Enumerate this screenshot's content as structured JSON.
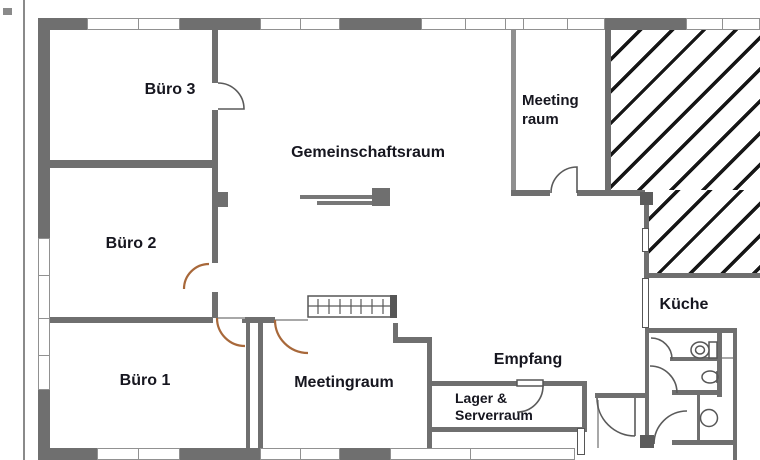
{
  "title": "Office floor plan",
  "labels": {
    "buero3": "Büro 3",
    "buero2": "Büro 2",
    "buero1": "Büro 1",
    "gemeinschaftsraum": "Gemeinschaftsraum",
    "meetingraum": "Meetingraum",
    "meeting_raum_line1": "Meeting",
    "meeting_raum_line2": "raum",
    "kueche": "Küche",
    "empfang": "Empfang",
    "lager_line1": "Lager &",
    "lager_line2": "Serverraum"
  },
  "rooms": [
    {
      "name": "Büro 3"
    },
    {
      "name": "Büro 2"
    },
    {
      "name": "Büro 1"
    },
    {
      "name": "Gemeinschaftsraum"
    },
    {
      "name": "Meetingraum"
    },
    {
      "name": "Meeting raum"
    },
    {
      "name": "Küche"
    },
    {
      "name": "Empfang"
    },
    {
      "name": "Lager & Serverraum"
    }
  ],
  "fixtures": [
    "toilet",
    "urinal",
    "sink",
    "radiator",
    "sideboard-table",
    "door",
    "window"
  ],
  "colors": {
    "wall": "#6f6f6f",
    "wall_light": "#8f8f8f",
    "pillar": "#5c5c5c",
    "door_arc": "#5a5a5a",
    "door_arc_accent": "#a8683a",
    "hatch": "#161616",
    "text": "#16161f",
    "background": "#ffffff"
  }
}
